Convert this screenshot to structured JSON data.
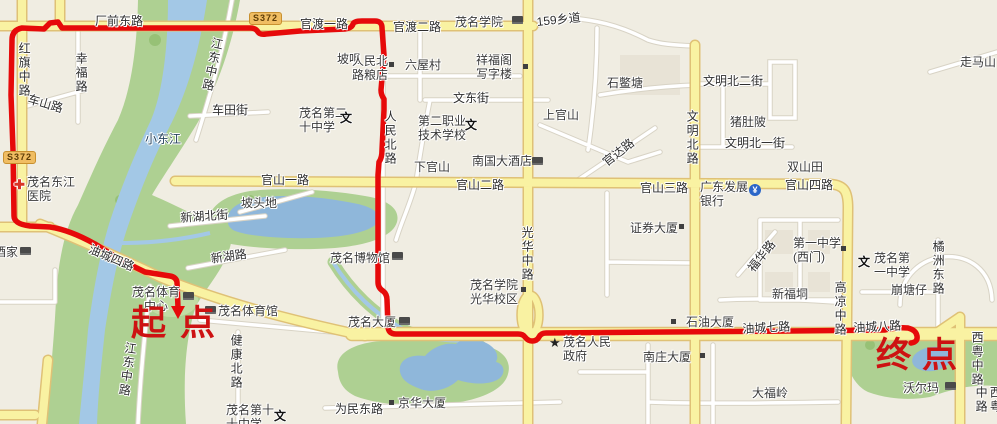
{
  "map": {
    "start_marker": "起点",
    "end_marker": "终点",
    "colors": {
      "land": "#f0ede2",
      "park": "#aed092",
      "water": "#a3c8e6",
      "lake": "#8fb7da",
      "road_major_fill": "#f9f2a2",
      "road_major_casing": "#dfc176",
      "road_minor_fill": "#ffffff",
      "road_minor_casing": "#d8d3c5",
      "route": "#e60a0a",
      "marker_text": "#cd1212",
      "badge_bg": "#f0bd62"
    },
    "badges": [
      {
        "name": "badge-s372-west",
        "text": "S372",
        "x": 3,
        "y": 151
      },
      {
        "name": "badge-s372-north",
        "text": "S372",
        "x": 249,
        "y": 12
      }
    ],
    "labels": [
      {
        "name": "road-changqiandonglu",
        "text": "厂前东路",
        "x": 95,
        "y": 14,
        "kind": "road"
      },
      {
        "name": "road-guandu-1-lu",
        "text": "官渡一路",
        "x": 300,
        "y": 17,
        "kind": "road"
      },
      {
        "name": "road-guandu-2-lu",
        "text": "官渡二路",
        "x": 393,
        "y": 20,
        "kind": "road"
      },
      {
        "name": "poi-maoming-xueyuan",
        "text": "茂名学院",
        "x": 455,
        "y": 15,
        "kind": "poi"
      },
      {
        "name": "road-159-xiangdao",
        "text": "159乡道",
        "x": 536,
        "y": 15,
        "kind": "road",
        "rot": -6
      },
      {
        "name": "road-hongqi-zhonglu",
        "text": "红旗中路",
        "x": 17,
        "y": 42,
        "kind": "roadv"
      },
      {
        "name": "road-xingfulu",
        "text": "幸福路",
        "x": 74,
        "y": 52,
        "kind": "roadv"
      },
      {
        "name": "road-cheshanlu",
        "text": "车山路",
        "x": 30,
        "y": 92,
        "kind": "road",
        "rot": 16
      },
      {
        "name": "road-jiangdong-zhonglu-n",
        "text": "江东中路",
        "x": 211,
        "y": 36,
        "kind": "roadv",
        "rot": 12
      },
      {
        "name": "road-chetianjie",
        "text": "车田街",
        "x": 212,
        "y": 103,
        "kind": "road"
      },
      {
        "name": "poi-maoming-no20-school",
        "text": "茂名第二\n十中学",
        "x": 299,
        "y": 106,
        "kind": "poi"
      },
      {
        "name": "place-pozui",
        "text": "坡咀",
        "x": 337,
        "y": 52,
        "kind": "place"
      },
      {
        "name": "poi-renminbeilu-liangdian",
        "text": "人民北\n路粮店",
        "x": 352,
        "y": 54,
        "kind": "poi"
      },
      {
        "name": "place-liuwucun",
        "text": "六屋村",
        "x": 405,
        "y": 58,
        "kind": "place"
      },
      {
        "name": "poi-xiangfuge-xiezilou",
        "text": "祥福阁\n写字楼",
        "x": 476,
        "y": 53,
        "kind": "poi"
      },
      {
        "name": "road-wendongjie",
        "text": "文东街",
        "x": 453,
        "y": 91,
        "kind": "road"
      },
      {
        "name": "place-shangguanshan",
        "text": "上官山",
        "x": 543,
        "y": 108,
        "kind": "place"
      },
      {
        "name": "place-shibietang",
        "text": "石鳖塘",
        "x": 607,
        "y": 76,
        "kind": "place"
      },
      {
        "name": "road-guandalu",
        "text": "官达路",
        "x": 600,
        "y": 158,
        "kind": "road",
        "rot": -38
      },
      {
        "name": "place-zoumashan",
        "text": "走马山",
        "x": 960,
        "y": 55,
        "kind": "place"
      },
      {
        "name": "road-wenmingbei-2-jie",
        "text": "文明北二街",
        "x": 703,
        "y": 74,
        "kind": "road"
      },
      {
        "name": "place-zhudupo",
        "text": "猪肚陂",
        "x": 730,
        "y": 115,
        "kind": "place"
      },
      {
        "name": "road-wenmingbei-1-jie",
        "text": "文明北一街",
        "x": 725,
        "y": 136,
        "kind": "road"
      },
      {
        "name": "road-wenmingbeilu",
        "text": "文明北路",
        "x": 685,
        "y": 110,
        "kind": "roadv"
      },
      {
        "name": "place-shuangshantian",
        "text": "双山田",
        "x": 787,
        "y": 160,
        "kind": "place"
      },
      {
        "name": "road-guanshan-3-lu",
        "text": "官山三路",
        "x": 640,
        "y": 181,
        "kind": "road"
      },
      {
        "name": "road-guanshan-4-lu",
        "text": "官山四路",
        "x": 785,
        "y": 178,
        "kind": "road"
      },
      {
        "name": "poi-guangdong-fazhan-bank",
        "text": "广东发展\n银行",
        "x": 700,
        "y": 180,
        "kind": "poi"
      },
      {
        "name": "road-guanshan-2-lu",
        "text": "官山二路",
        "x": 456,
        "y": 178,
        "kind": "road"
      },
      {
        "name": "place-xiaguanshan",
        "text": "下官山",
        "x": 414,
        "y": 160,
        "kind": "place"
      },
      {
        "name": "poi-nanguo-dajiudian",
        "text": "南国大酒店",
        "x": 472,
        "y": 154,
        "kind": "poi"
      },
      {
        "name": "poi-dier-zhiye-school",
        "text": "第二职业\n技术学校",
        "x": 418,
        "y": 114,
        "kind": "poi"
      },
      {
        "name": "road-renminbeilu",
        "text": "人民北路",
        "x": 383,
        "y": 110,
        "kind": "roadv"
      },
      {
        "name": "road-guanghua-zhonglu",
        "text": "光华中路",
        "x": 520,
        "y": 226,
        "kind": "roadv"
      },
      {
        "name": "poi-zhengquan-dasha",
        "text": "证券大厦",
        "x": 630,
        "y": 221,
        "kind": "poi"
      },
      {
        "name": "poi-maoming-bowuguan",
        "text": "茂名博物馆",
        "x": 330,
        "y": 251,
        "kind": "poi"
      },
      {
        "name": "road-guanshan-1-lu",
        "text": "官山一路",
        "x": 261,
        "y": 173,
        "kind": "road"
      },
      {
        "name": "place-potoudi",
        "text": "坡头地",
        "x": 241,
        "y": 196,
        "kind": "place"
      },
      {
        "name": "road-xinhubeijie",
        "text": "新湖北街",
        "x": 180,
        "y": 211,
        "kind": "road",
        "rot": -4
      },
      {
        "name": "road-xinhulu",
        "text": "新湖路",
        "x": 210,
        "y": 252,
        "kind": "road",
        "rot": -8
      },
      {
        "name": "water-xiaodongjiang",
        "text": "小东江",
        "x": 145,
        "y": 132,
        "kind": "water"
      },
      {
        "name": "poi-dongjiang-hospital",
        "text": "茂名东江\n医院",
        "x": 27,
        "y": 175,
        "kind": "poi"
      },
      {
        "name": "road-youcheng-4-lu",
        "text": "油城四路",
        "x": 92,
        "y": 242,
        "kind": "road",
        "rot": 23
      },
      {
        "name": "poi-jiujia",
        "text": "酒家",
        "x": -6,
        "y": 245,
        "kind": "poi"
      },
      {
        "name": "poi-maoming-tiyu-zhongxin",
        "text": "茂名体育\n　中心",
        "x": 132,
        "y": 285,
        "kind": "poi"
      },
      {
        "name": "poi-maoming-tiyuguan",
        "text": "茂名体育馆",
        "x": 218,
        "y": 304,
        "kind": "poi"
      },
      {
        "name": "road-jiangdong-zhonglu-s",
        "text": "江东中路",
        "x": 124,
        "y": 341,
        "kind": "roadv",
        "rot": 8
      },
      {
        "name": "road-jiankangbeilu",
        "text": "健康北路",
        "x": 229,
        "y": 334,
        "kind": "roadv"
      },
      {
        "name": "poi-maoming-no10-school",
        "text": "茂名第十\n十中学",
        "x": 226,
        "y": 403,
        "kind": "poi"
      },
      {
        "name": "road-weimindonglu",
        "text": "为民东路",
        "x": 335,
        "y": 402,
        "kind": "road"
      },
      {
        "name": "poi-jinghua-dasha",
        "text": "京华大厦",
        "x": 398,
        "y": 396,
        "kind": "poi"
      },
      {
        "name": "poi-maoming-dasha",
        "text": "茂名大厦",
        "x": 348,
        "y": 315,
        "kind": "poi"
      },
      {
        "name": "poi-guanghua-xiaoqu",
        "text": "茂名学院\n光华校区",
        "x": 470,
        "y": 278,
        "kind": "poi"
      },
      {
        "name": "poi-renmin-zhengfu",
        "text": "茂名人民\n政府",
        "x": 563,
        "y": 335,
        "kind": "poi"
      },
      {
        "name": "poi-nanzhuang-dasha",
        "text": "南庄大厦",
        "x": 643,
        "y": 350,
        "kind": "poi"
      },
      {
        "name": "poi-shiyou-dasha",
        "text": "石油大厦",
        "x": 686,
        "y": 315,
        "kind": "poi"
      },
      {
        "name": "road-youcheng-7-lu",
        "text": "油城七路",
        "x": 742,
        "y": 322,
        "kind": "road",
        "rot": -3
      },
      {
        "name": "road-youcheng-8-lu",
        "text": "油城八路",
        "x": 853,
        "y": 321,
        "kind": "road",
        "rot": -3
      },
      {
        "name": "place-xinfudong",
        "text": "新福垌",
        "x": 772,
        "y": 287,
        "kind": "place"
      },
      {
        "name": "road-gaoliang-zhonglu",
        "text": "高凉中路",
        "x": 833,
        "y": 281,
        "kind": "roadv"
      },
      {
        "name": "place-bengtangzai",
        "text": "崩塘仔",
        "x": 891,
        "y": 283,
        "kind": "place"
      },
      {
        "name": "poi-maoming-no1-school",
        "text": "茂名第\n一中学",
        "x": 874,
        "y": 251,
        "kind": "poi"
      },
      {
        "name": "poi-no1-school-westgate",
        "text": "第一中学\n(西门)",
        "x": 793,
        "y": 236,
        "kind": "poi"
      },
      {
        "name": "road-fuhualu",
        "text": "福华路",
        "x": 745,
        "y": 266,
        "kind": "road",
        "rot": -52
      },
      {
        "name": "road-juzhou-donglu",
        "text": "橘洲东路",
        "x": 931,
        "y": 240,
        "kind": "roadv"
      },
      {
        "name": "place-dafuling",
        "text": "大福岭",
        "x": 752,
        "y": 386,
        "kind": "place"
      },
      {
        "name": "poi-walmart",
        "text": "沃尔玛",
        "x": 903,
        "y": 381,
        "kind": "poi"
      },
      {
        "name": "road-xiyue-zhonglu-1",
        "text": "西粤中路",
        "x": 970,
        "y": 331,
        "kind": "roadv"
      },
      {
        "name": "road-xiyue-zhonglu-2",
        "text": "西粤中路",
        "x": 974,
        "y": 386,
        "kind": "roadv"
      }
    ],
    "icons": [
      {
        "name": "college-icon",
        "kind": "block",
        "x": 512,
        "y": 16
      },
      {
        "name": "school-wen-icon-no20",
        "kind": "wen",
        "glyph": "文",
        "x": 340,
        "y": 112
      },
      {
        "name": "school-wen-icon-zhiye",
        "kind": "wen",
        "glyph": "文",
        "x": 465,
        "y": 119
      },
      {
        "name": "school-wen-icon-no1",
        "kind": "wen",
        "glyph": "文",
        "x": 858,
        "y": 256
      },
      {
        "name": "school-wen-icon-no10",
        "kind": "wen",
        "glyph": "文",
        "x": 274,
        "y": 410
      },
      {
        "name": "building-marker-liangdian",
        "kind": "marker",
        "x": 389,
        "y": 62
      },
      {
        "name": "building-marker-xiangfuge",
        "kind": "marker",
        "x": 523,
        "y": 64
      },
      {
        "name": "building-marker-zhengquan",
        "kind": "marker",
        "x": 679,
        "y": 224
      },
      {
        "name": "building-marker-jinghua",
        "kind": "marker",
        "x": 389,
        "y": 400
      },
      {
        "name": "building-marker-guanghuaxq",
        "kind": "marker",
        "x": 521,
        "y": 287
      },
      {
        "name": "building-marker-nanzhuang",
        "kind": "marker",
        "x": 700,
        "y": 353
      },
      {
        "name": "building-marker-shiyou",
        "kind": "marker",
        "x": 671,
        "y": 319
      },
      {
        "name": "building-marker-xi-men",
        "kind": "marker",
        "x": 841,
        "y": 246
      },
      {
        "name": "hotel-icon-nanguo",
        "kind": "block",
        "x": 532,
        "y": 157
      },
      {
        "name": "hotel-icon-maoming-dasha",
        "kind": "block",
        "x": 399,
        "y": 317
      },
      {
        "name": "hotel-icon-jiujia",
        "kind": "block",
        "x": 20,
        "y": 247
      },
      {
        "name": "hospital-cross-icon",
        "kind": "hospital",
        "glyph": "✚",
        "x": 14,
        "y": 178
      },
      {
        "name": "government-star-icon",
        "kind": "star",
        "glyph": "★",
        "x": 549,
        "y": 337
      },
      {
        "name": "bank-icon",
        "kind": "bank",
        "glyph": "¥",
        "x": 749,
        "y": 184
      },
      {
        "name": "museum-icon",
        "kind": "block",
        "x": 392,
        "y": 252
      },
      {
        "name": "stadium-icon-zhongxin",
        "kind": "block",
        "x": 183,
        "y": 292
      },
      {
        "name": "stadium-icon-tiyuguan",
        "kind": "block",
        "x": 205,
        "y": 306
      },
      {
        "name": "walmart-icon",
        "kind": "block",
        "x": 945,
        "y": 382
      }
    ]
  }
}
